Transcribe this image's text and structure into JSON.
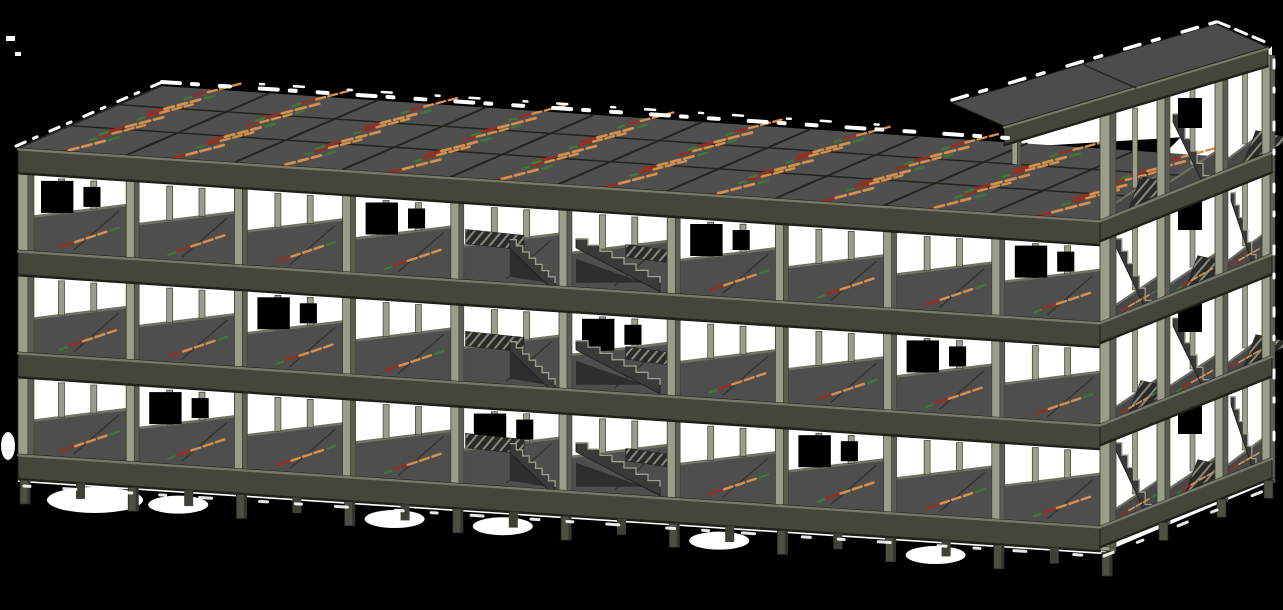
{
  "meta": {
    "description": "3D axonometric viewport of a multi-storey reinforced concrete structural frame model: three suspended floor levels plus roof slab on a beam-column grid, slab span-direction markings, interior staircases, foundation pier stubs, and a four-level stair tower at the right end"
  },
  "colors": {
    "background": "#000000",
    "matte_white": "#ffffff",
    "roof_top": "#4f4f4f",
    "roof_line": "#24251f",
    "edge_highlight": "#767968",
    "beam_band": "#44463c",
    "band_top": "#767968",
    "band_shadow": "#1f211b",
    "column_light": "#9a9d8a",
    "column_dark": "#5a5d50",
    "column_edge": "#3a3c33",
    "interior_slab": "#4e4e4e",
    "interior_beam": "#6f7263",
    "stair_flight": "#3a3a3a",
    "stair_tread": "#9da08c",
    "landing_fill": "#2b2b2b",
    "hatch_line": "#878a77",
    "stub": "#4c4f44",
    "stub_back": "#3e4138",
    "tower_slab": "#484848",
    "roof_face_tower": "#4c4c4c",
    "wedge_dark": "#2e2e2e"
  },
  "building": {
    "storeys": 3,
    "bays": 10,
    "depth_rows": 3,
    "bay_width": 108.2,
    "storey_pitch": 102,
    "band_height": 26,
    "origin_x": 18,
    "origin_y": 148,
    "slope": 0.0665,
    "depth_dx": 143,
    "depth_dy": -62,
    "level_tops": [
      148,
      250,
      352,
      454
    ],
    "opening_tops": [
      174,
      276,
      378
    ],
    "opening_height": 76,
    "ground_bottom": 480,
    "stair_bays": [
      4,
      5
    ]
  },
  "tower": {
    "levels": 4,
    "x0": 1100,
    "x_end": 1272,
    "slope": -0.4,
    "level_tops": [
      118,
      220,
      322,
      424,
      526
    ],
    "band_height": 22,
    "column_xs": [
      1100,
      1157,
      1215,
      1262
    ],
    "roof_slope": -0.3,
    "roof_poly": [
      [
        1004,
        126
      ],
      [
        1268,
        47
      ],
      [
        1216,
        24
      ],
      [
        952,
        103
      ]
    ]
  },
  "foundation": {
    "stub_width": 10,
    "stub_height": 24,
    "back_stub_height": 16,
    "blob_bays": [
      1,
      3,
      4,
      6,
      8
    ]
  },
  "markings": {
    "orange": "#d6904c",
    "red": "#9c2b20",
    "green": "#3e7a33",
    "roof_angle": -11,
    "face_angle": -15,
    "tower_angle": -26
  }
}
